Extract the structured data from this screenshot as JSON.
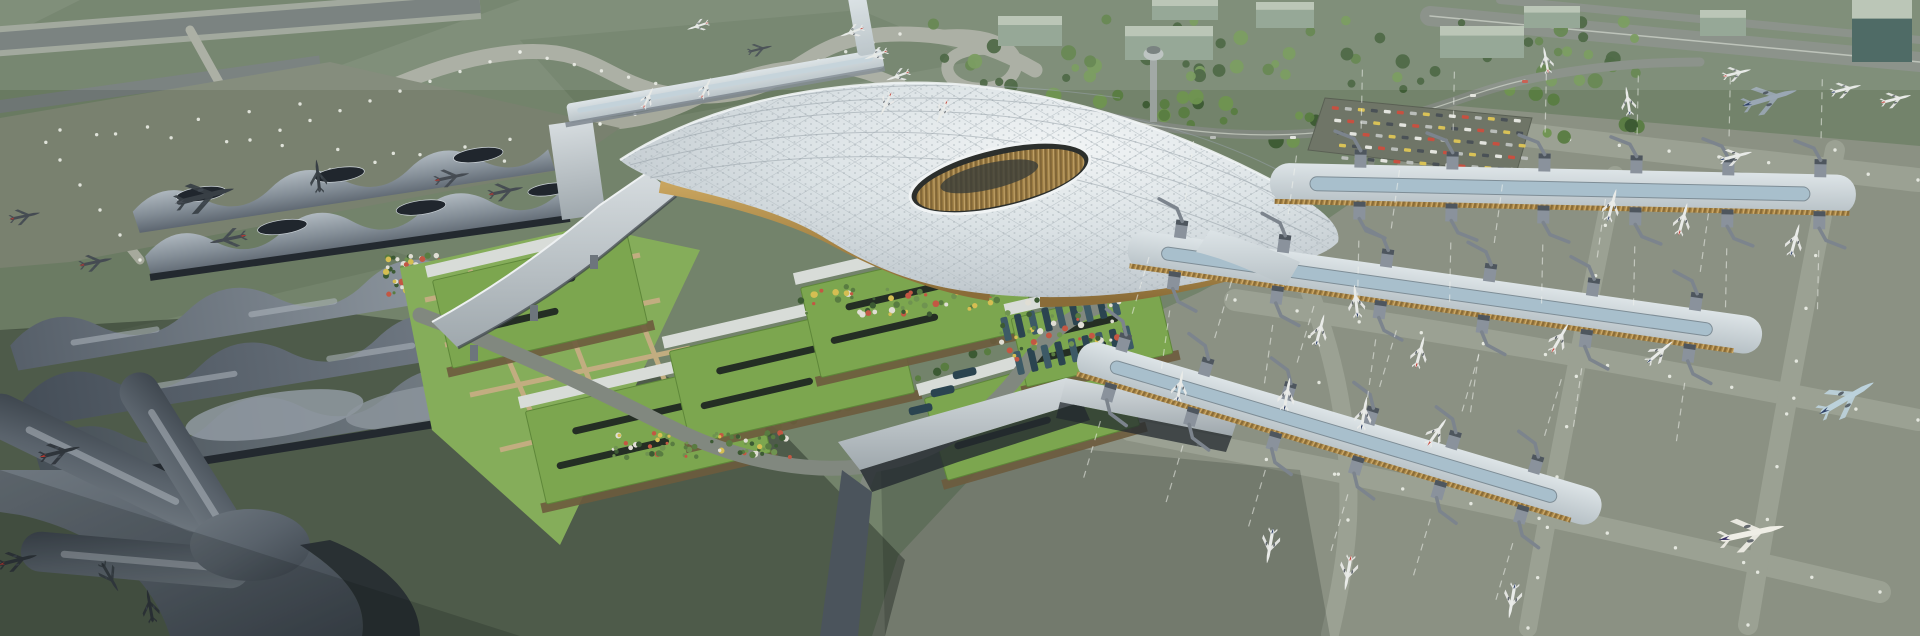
{
  "scene": {
    "title": "Aerial rendering of an airport terminal complex with flowing white canopy roof, green-roofed landside blocks, wave-roofed older terminal and three aircraft piers",
    "landmarks": [
      "runways-and-taxiways",
      "remote-stand-pier",
      "old-terminal-wave-roofs",
      "y-shaped-concourse",
      "elevated-approach-viaduct",
      "green-roof-blocks",
      "main-terminal-canopy",
      "pier-north",
      "pier-middle",
      "pier-south",
      "airside-apron",
      "car-parking-lot",
      "control-tower",
      "tree-belt",
      "bus-depot"
    ]
  },
  "colors": {
    "grass": "#73836b",
    "grassDark": "#5f7158",
    "runway": "#6e7674",
    "runwayShoulder": "#9aa194",
    "taxiway": "#a6a99c",
    "apronLeft": "#79816f",
    "apronRight": "#8b9183",
    "apronBand": "#9ba193",
    "shadowTint": "rgba(18,26,22,0.38)",
    "marking": "#f1f3ec",
    "lensDark": "#20262d",
    "lensRim": "#cdd4d9",
    "slotLight": "#aeb7be",
    "darkGlass": "#23292f",
    "canopyLine": "#97a1a8",
    "canopyDot": "#9aa4aa",
    "canopyHi": "#f1f4f5",
    "canopyMid": "#ccd4d8",
    "canopyLo": "#a9b2b9",
    "goldHi": "#c8a45e",
    "goldLo": "#8a6c38",
    "lawn": "#85ad5a",
    "greenRoof": "#7ca64f",
    "greenRoofEdge": "#5e8739",
    "roofSlot": "#242e24",
    "canopyStrip": "#d8dcd8",
    "facadeBrown": "#6d5b3d",
    "pathTan": "#c2ad80",
    "road": "#81887f",
    "roadHi": "#b9bfb4",
    "viaductHi": "#d6dcdf",
    "viaductLo": "#9fa8ad",
    "pierRoofHi": "#dde4e7",
    "pierRoofLo": "#b7c1c6",
    "pierSkylight": "#a8bfcc",
    "pierFrame": "#7e8d96",
    "towerGray": "#8a929c",
    "towerDark": "#4e565e",
    "bridgeGray": "#7c848d",
    "bldgTop": "#b7c2b1",
    "bldgFace": "#8da08c",
    "bldgTall": "#3c5a55",
    "parkingBase": "#6f7567",
    "parkingEdge": "#5a6054",
    "treeDark": "#3c5a33",
    "treeMid": "#597c41",
    "treeLight": "#6f9350",
    "flowerYellow": "#d5be52",
    "flowerRed": "#c35743",
    "flowerWhite": "#e0ded4",
    "busTeal": "#2b4450",
    "busTealLight": "#3d5a66",
    "carRed": "#c75040",
    "carYellow": "#d9c257",
    "carWhite": "#e3e4de",
    "carSilver": "#b9bdb9",
    "carDark": "#4a5156",
    "planeWhite": "#e9ebe8",
    "planeCream": "#efeee6",
    "planeGray": "#9aa7b4",
    "planeBlue": "#bcd2dc",
    "planeDark": "#383f45",
    "planeDark2": "#2f353b",
    "tailRed": "#bf3a31",
    "tailNavy": "#2f4168",
    "tailIndigo": "#3a3168",
    "tailDark": "#454b52",
    "waveHi": "#a9b2b8",
    "waveLo": "#555e68",
    "waveLo2": "#434c56",
    "yRoofHi": "#8d969e",
    "yRoofLo": "#3d454d"
  }
}
